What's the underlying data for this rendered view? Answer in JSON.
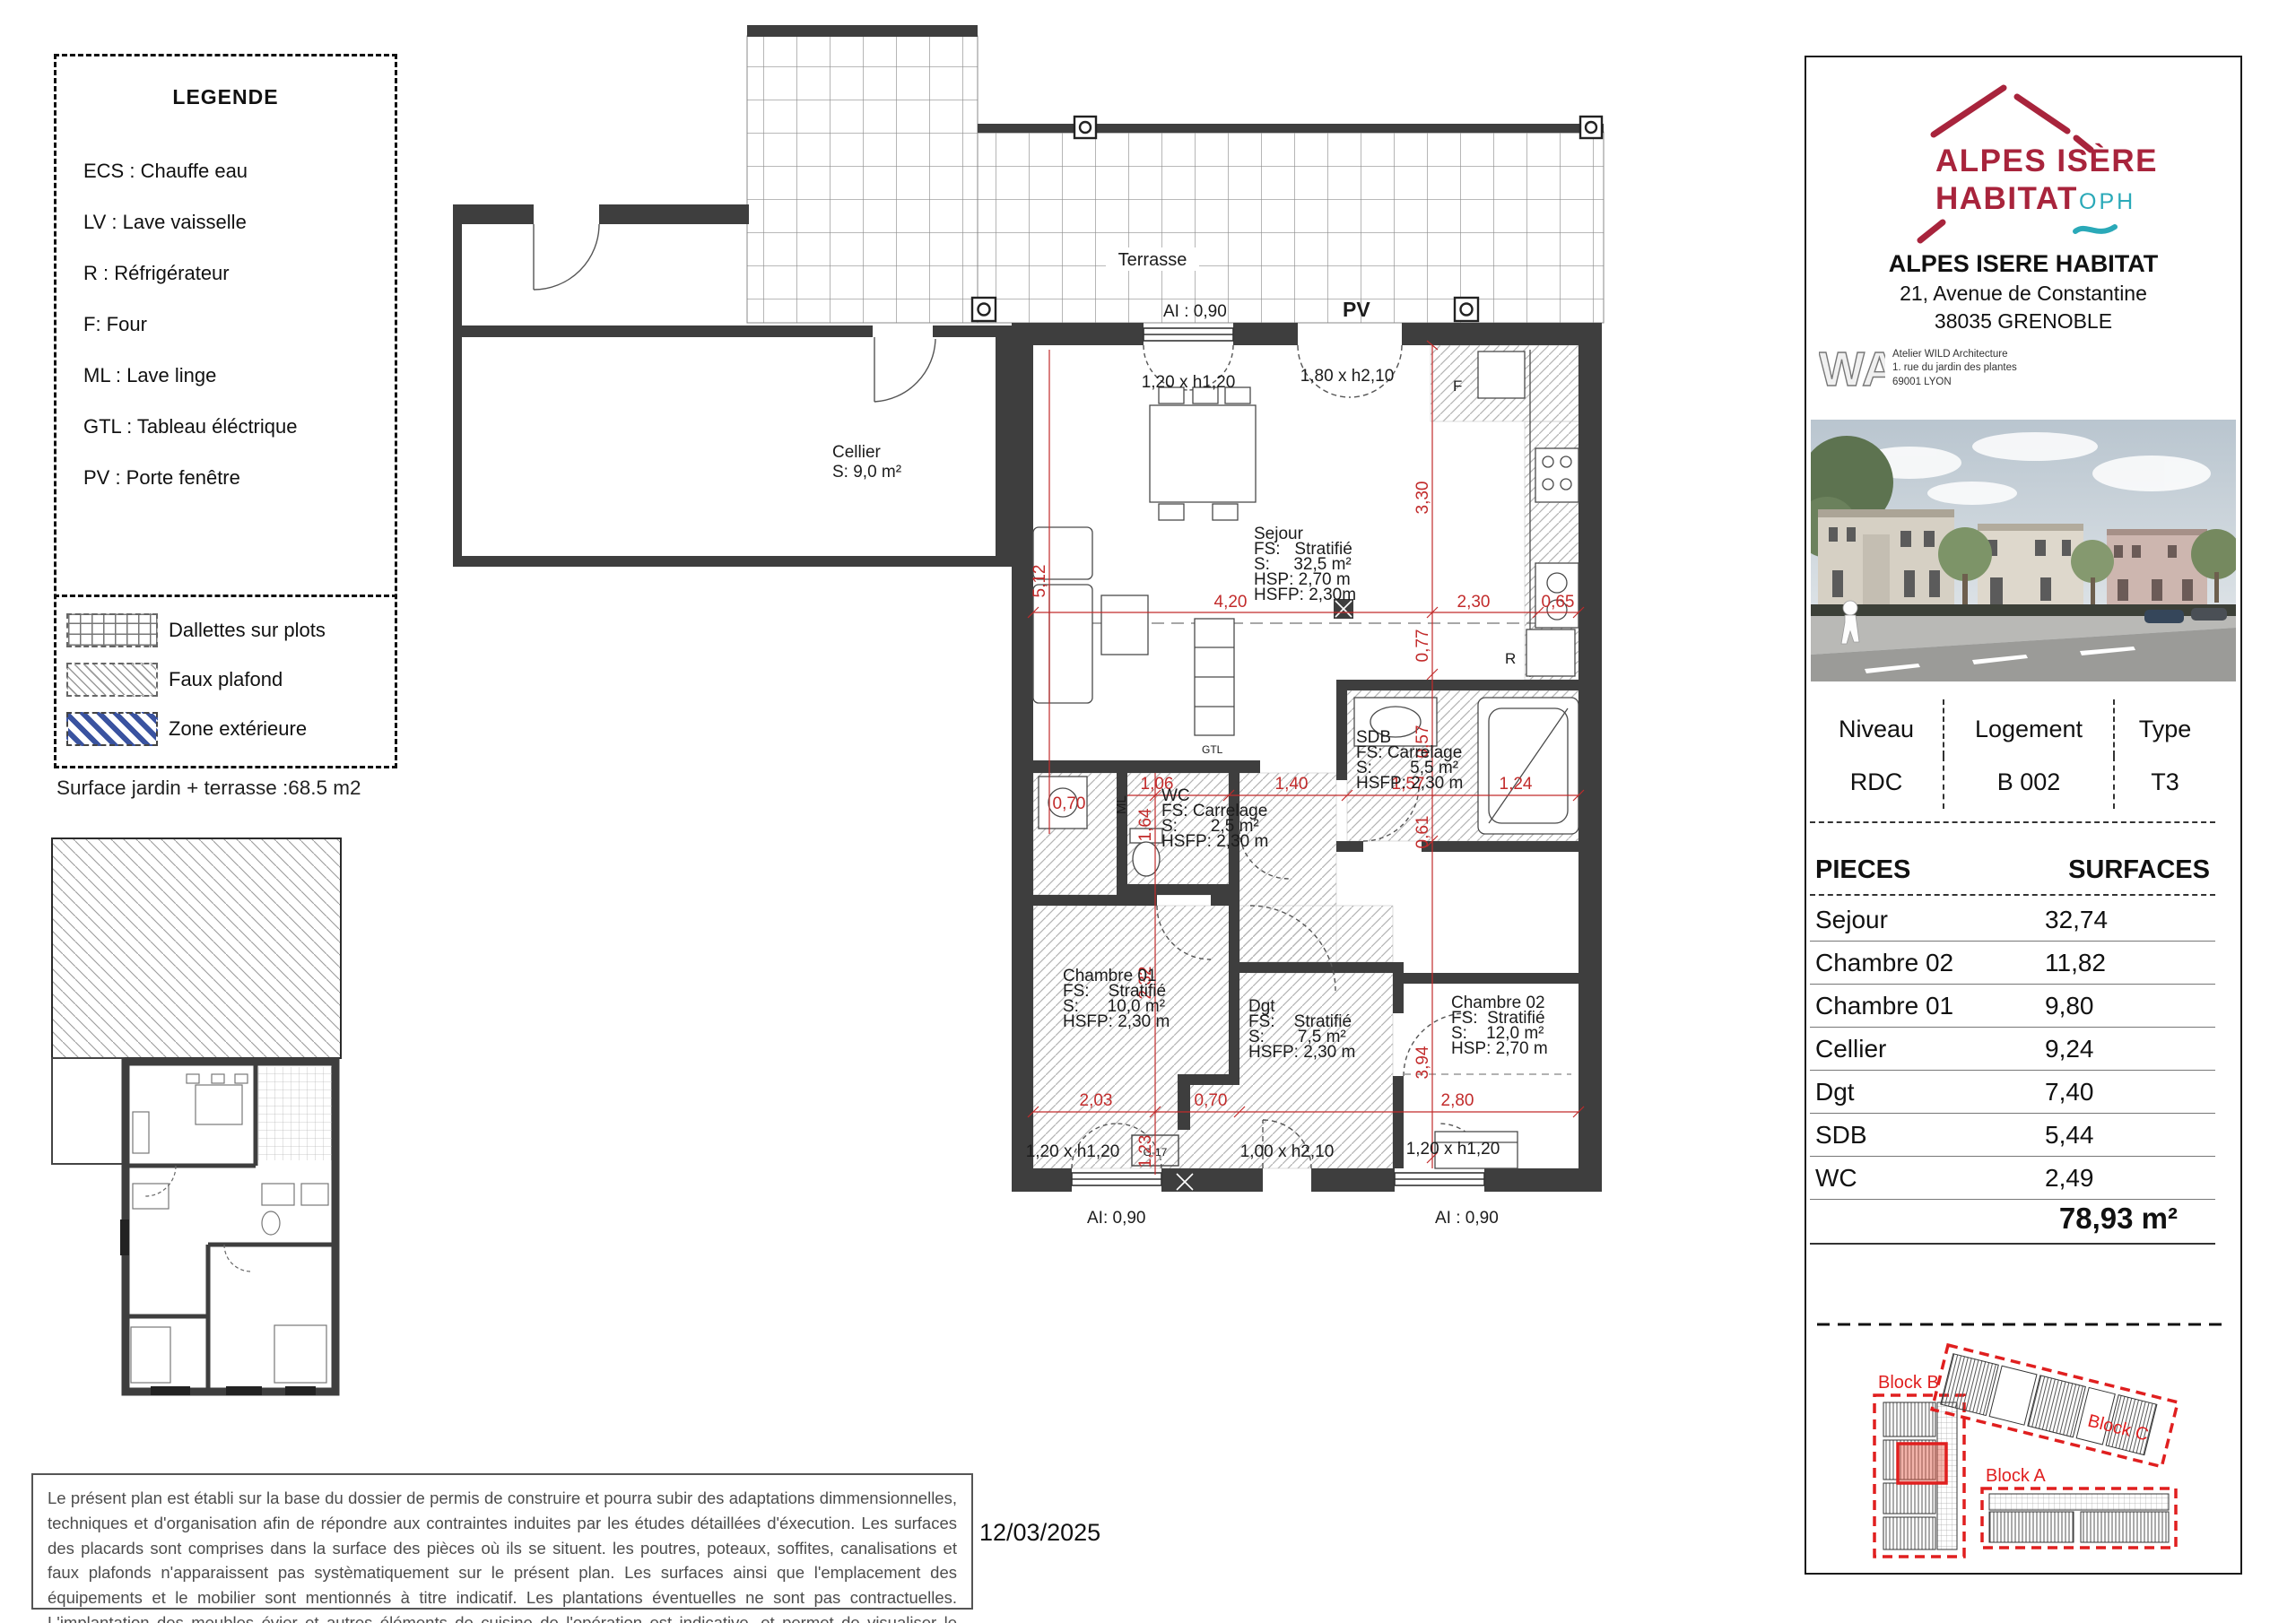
{
  "colors": {
    "wall": "#3E3E3E",
    "dim_red": "#C22B2B",
    "logo_red": "#A8243C",
    "oph_teal": "#2AA9B8",
    "block_red": "#E01F1F",
    "zone_blue": "#3A53A0"
  },
  "legend": {
    "title": "LEGENDE",
    "items": [
      {
        "label": "ECS : Chauffe eau"
      },
      {
        "label": "LV : Lave vaisselle"
      },
      {
        "label": "R : Réfrigérateur"
      },
      {
        "label": "F: Four"
      },
      {
        "label": "ML : Lave linge"
      },
      {
        "label": "GTL : Tableau éléctrique"
      },
      {
        "label": "PV : Porte fenêtre"
      }
    ],
    "patterns": [
      {
        "label": "Dallettes sur plots"
      },
      {
        "label": "Faux plafond"
      },
      {
        "label": "Zone extérieure"
      }
    ]
  },
  "surface_note": "Surface jardin + terrasse :68.5 m2",
  "plan": {
    "terrasse": "Terrasse",
    "pv": "PV",
    "ai_top": "AI : 0,90",
    "win_top": "1,20 x h1,20",
    "pv_dim": "1,80 x h2,10",
    "ai_bottom_left": "AI: 0,90",
    "ai_bottom_right": "AI : 0,90",
    "win_bottom_left": "1,20 x h1,20",
    "door_bottom": "1,00 x h2,10",
    "win_bottom_right": "1,20 x h1,20",
    "rooms": {
      "cellier": {
        "l1": "Cellier",
        "l2": "S: 9,0 m²"
      },
      "sejour": {
        "l1": "Sejour",
        "l2": "FS:   Stratifié",
        "l3": "S:     32,5 m²",
        "l4": "HSP: 2,70 m",
        "l5": "HSFP: 2,30m"
      },
      "sdb": {
        "l1": "SDB",
        "l2": "FS: Carrelage",
        "l3": "S:        5,5 m²",
        "l4": "HSFP: 2,30 m"
      },
      "wc": {
        "l1": "WC",
        "l2": "FS: Carrelage",
        "l3": "S:       2,5 m²",
        "l4": "HSFP: 2,30 m"
      },
      "chambre01": {
        "l1": "Chambre 01",
        "l2": "FS:    Stratifié",
        "l3": "S:      10,0 m²",
        "l4": "HSFP: 2,30 m"
      },
      "dgt": {
        "l1": "Dgt",
        "l2": "FS:    Stratifié",
        "l3": "S:       7,5 m²",
        "l4": "HSFP: 2,30 m"
      },
      "chambre02": {
        "l1": "Chambre 02",
        "l2": "FS:  Stratifié",
        "l3": "S:    12,0 m²",
        "l4": "HSP: 2,70 m"
      }
    },
    "dims": {
      "d420": "4,20",
      "d230": "2,30",
      "d065": "0,65",
      "d330": "3,30",
      "d077": "0,77",
      "d057": "0,57",
      "d061": "0,61",
      "d394": "3,94",
      "d512": "5,12",
      "d164": "1,64",
      "d232": "2,32",
      "d123": "1,23",
      "d106": "1,06",
      "d140": "1,40",
      "d157": "1,57",
      "d124": "1,24",
      "d203": "2,03",
      "d070": "0,70",
      "d280": "2,80",
      "d070b": "0,70"
    },
    "appliances": {
      "ml": "ML",
      "gtl": "GTL",
      "r": "R",
      "f": "F",
      "g17": "G-17"
    }
  },
  "panel": {
    "logo": {
      "line1": "ALPES ISÈRE",
      "line2": "HABITAT",
      "oph": "OPH"
    },
    "org": {
      "name": "ALPES ISERE HABITAT",
      "address": "21, Avenue de Constantine",
      "city": "38035 GRENOBLE"
    },
    "architect": {
      "monogram": "WA",
      "line1": "Atelier WILD Architecture",
      "line2": "1. rue du jardin des plantes",
      "line3": "69001 LYON"
    },
    "info": {
      "headers": [
        "Niveau",
        "Logement",
        "Type"
      ],
      "values": [
        "RDC",
        "B 002",
        "T3"
      ]
    },
    "pieces": {
      "header_left": "PIECES",
      "header_right": "SURFACES",
      "rows": [
        {
          "name": "Sejour",
          "value": "32,74"
        },
        {
          "name": "Chambre 02",
          "value": "11,82"
        },
        {
          "name": "Chambre 01",
          "value": "9,80"
        },
        {
          "name": "Cellier",
          "value": "9,24"
        },
        {
          "name": "Dgt",
          "value": "7,40"
        },
        {
          "name": "SDB",
          "value": "5,44"
        },
        {
          "name": "WC",
          "value": "2,49"
        }
      ],
      "total": "78,93 m²"
    },
    "blocks": {
      "b": "Block B",
      "c": "Block C",
      "a": "Block A"
    }
  },
  "footer": {
    "disclaimer": "Le présent plan est établi sur la base du dossier de permis de construire et pourra subir des adaptations dimmensionnelles, techniques et d'organisation afin de répondre aux contraintes induites par les études détaillées d'éxecution. Les surfaces des placards sont comprises dans la surface des pièces où ils se situent. les poutres, poteaux, soffites, canalisations et faux plafonds n'apparaissent pas systèmatiquement sur le présent plan. Les surfaces ainsi que l'emplacement des équipements et le mobilier sont mentionnés à titre indicatif. Les plantations éventuelles ne sont pas contractuelles. L'implantation des meubles évier et autres éléments de cuisine de l'opération est indicative, et permet de visualiser le positionnement des arrivées et évacuations d'eau à la livraison du logement.",
    "date": "12/03/2025"
  }
}
